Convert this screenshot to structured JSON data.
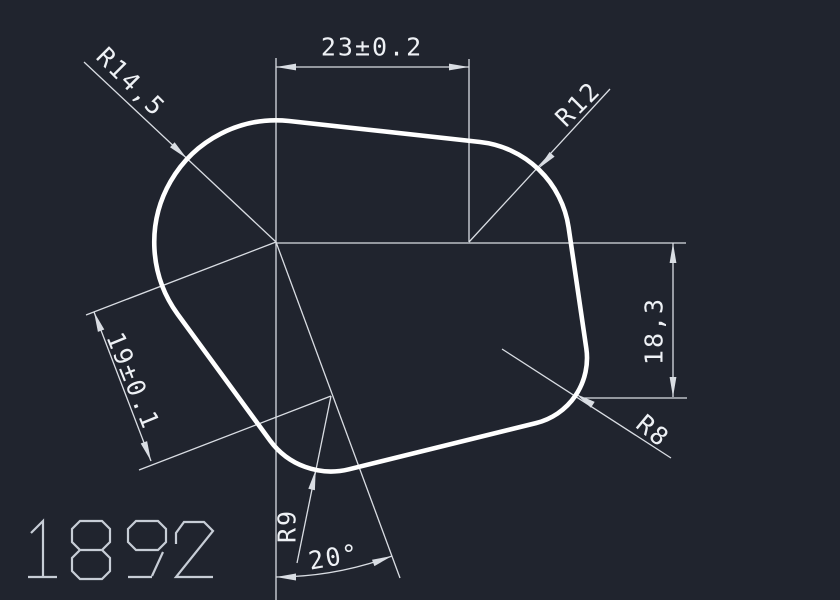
{
  "labels": {
    "dim_width": "23±0.2",
    "dim_height": "18,3",
    "dim_side": "19±0.1",
    "dim_angle": "20°",
    "radius_top_left": "R14,5",
    "radius_top_right": "R12",
    "radius_bottom_right": "R8",
    "radius_bottom": "R9",
    "part_number": "1892"
  },
  "colors": {
    "background": "#20242e",
    "outline": "#ffffff",
    "dimension": "#d9dde3",
    "text": "#eef1f5",
    "part_number": "#c7cdd6"
  }
}
